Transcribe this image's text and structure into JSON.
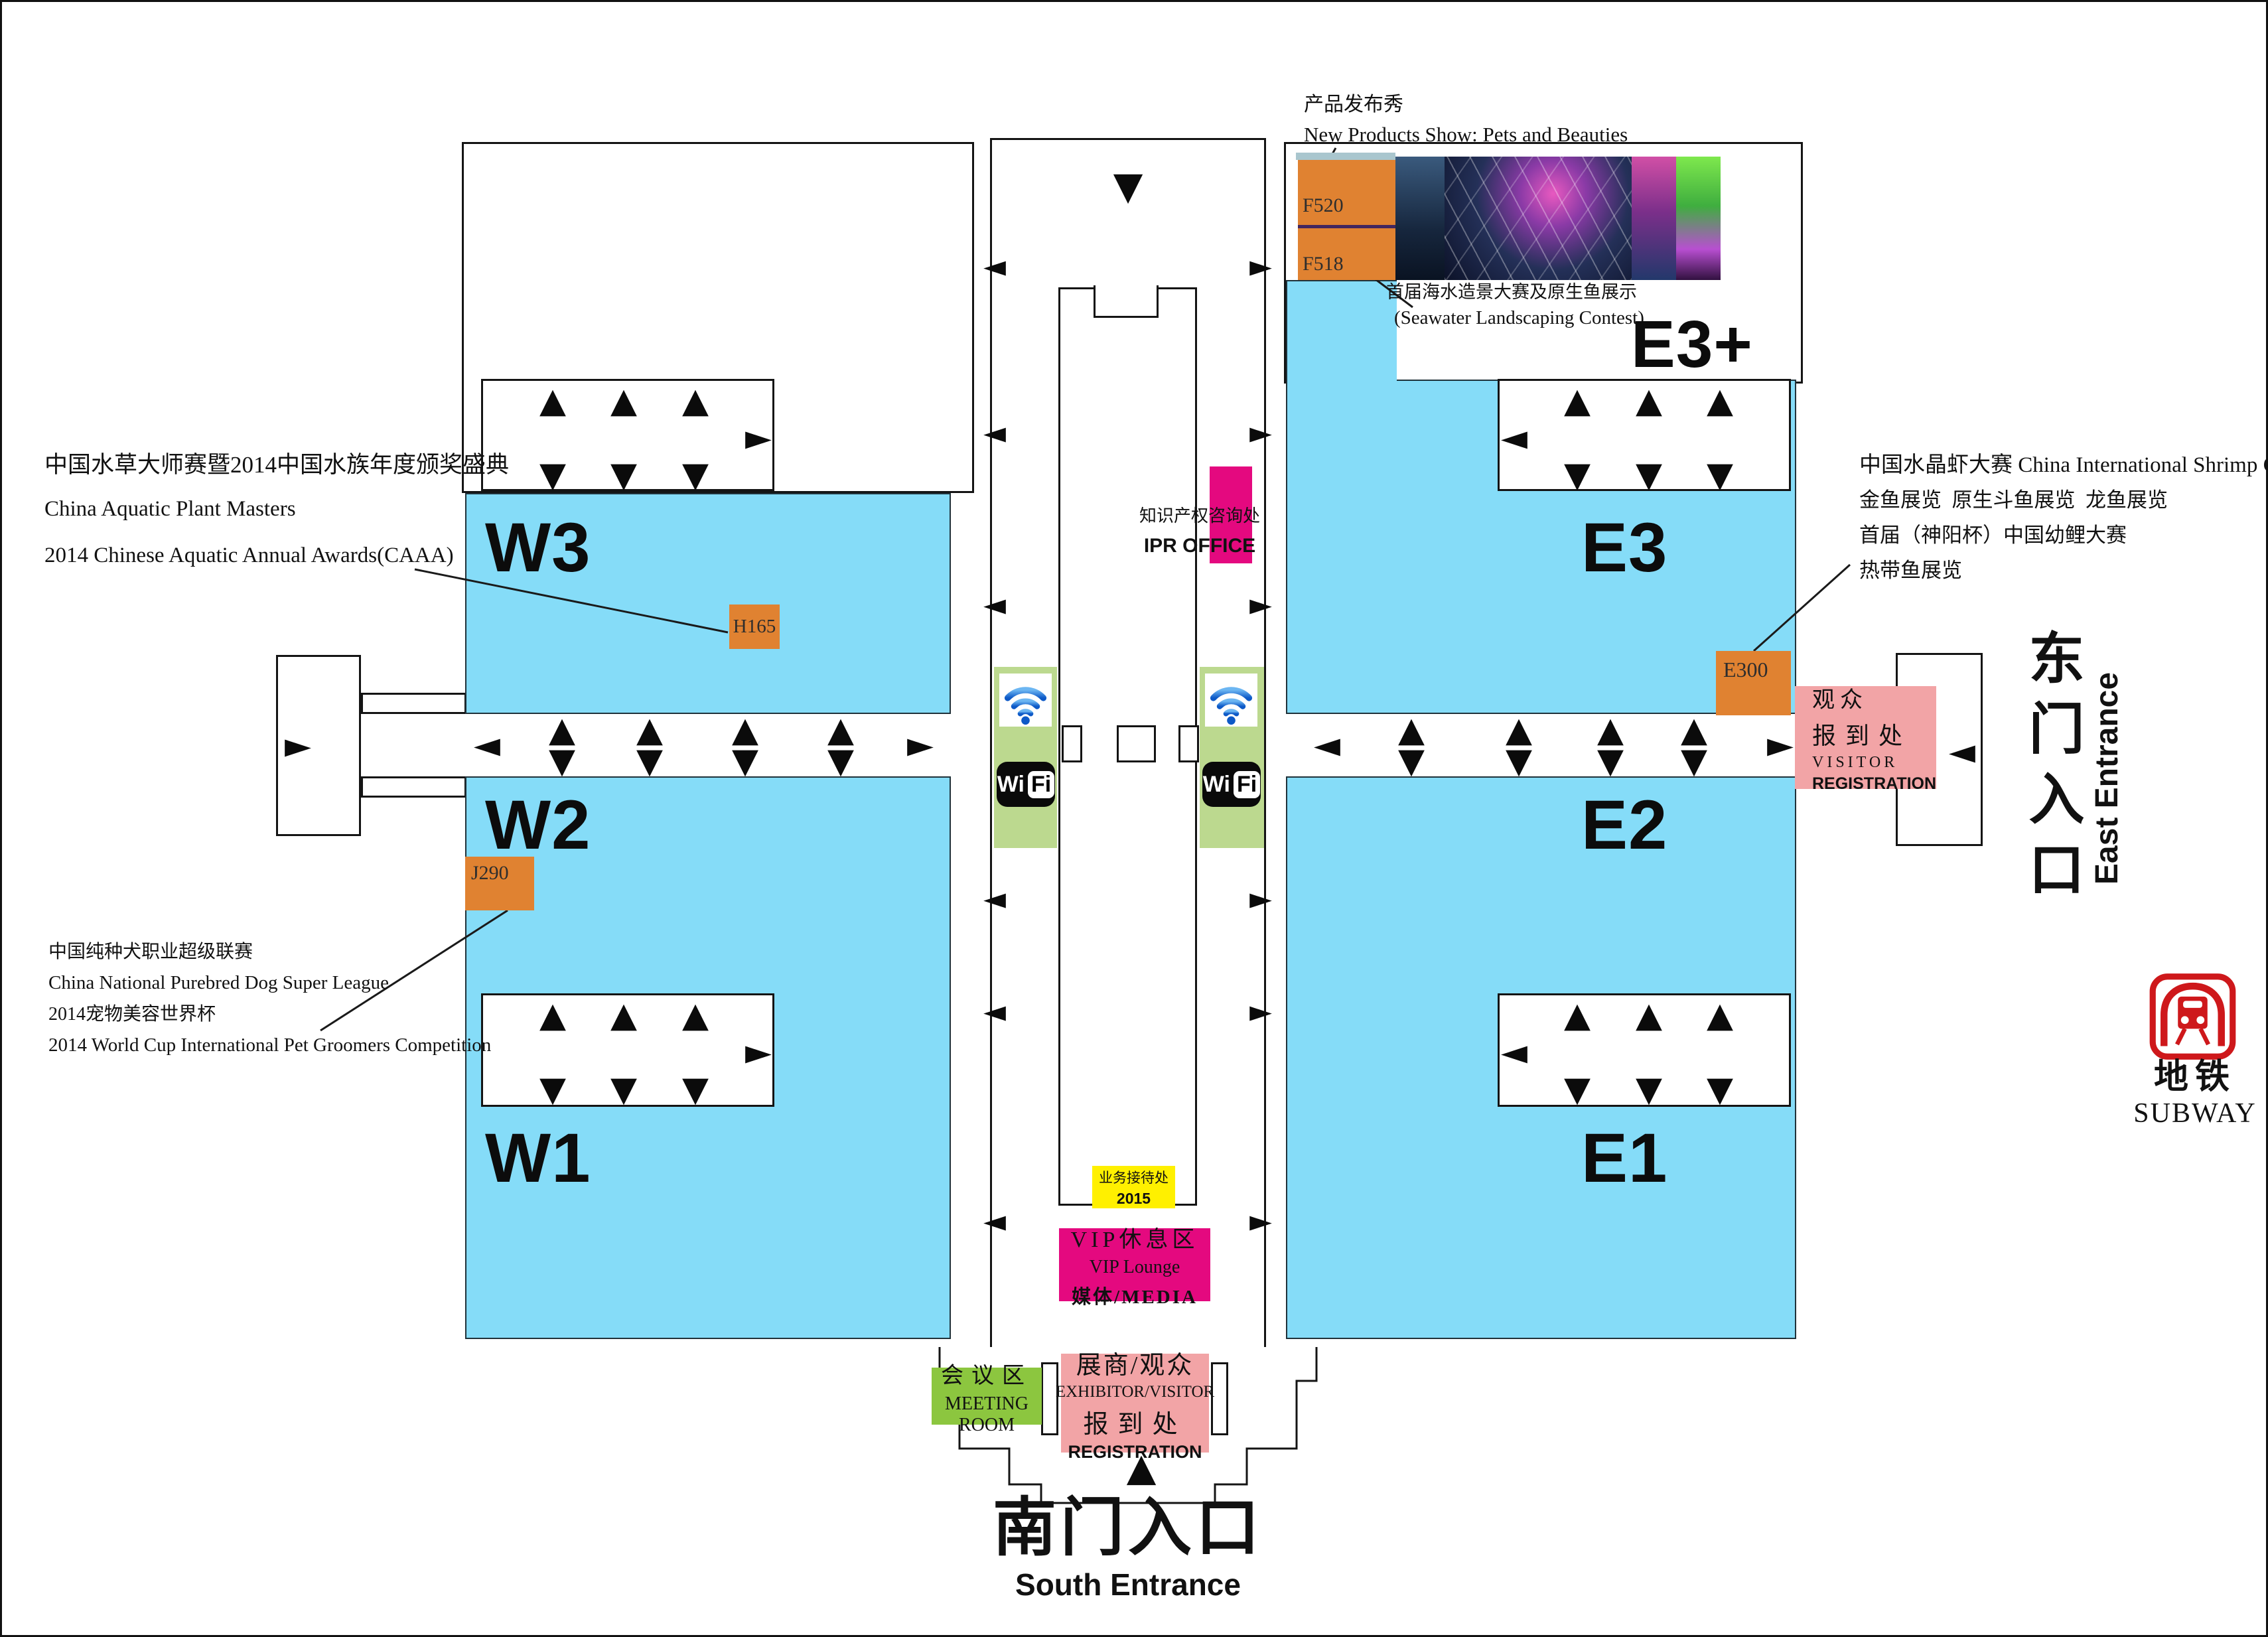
{
  "halls": {
    "w3": "W3",
    "w2": "W2",
    "w1": "W1",
    "e3": "E3",
    "e2": "E2",
    "e1": "E1",
    "e3_plus": "E3+"
  },
  "booths": {
    "h165": "H165",
    "j290": "J290",
    "e300": "E300",
    "f520": "F520",
    "f518": "F518"
  },
  "product_show": {
    "zh": "产品发布秀",
    "en": "New Products Show: Pets and Beauties"
  },
  "seawater": {
    "zh": "首届海水造景大赛及原生鱼展示",
    "en": "(Seawater Landscaping Contest)"
  },
  "notes_left_top": {
    "zh": "中国水草大师赛暨2014中国水族年度颁奖盛典",
    "en1": "China Aquatic Plant Masters",
    "en2": "2014 Chinese Aquatic Annual Awards(CAAA)"
  },
  "notes_left_bottom": {
    "zh1": "中国纯种犬职业超级联赛",
    "en1": "China National Purebred Dog Super League",
    "zh2": "2014宠物美容世界杯",
    "en2": "2014 World Cup International Pet Groomers Competition"
  },
  "notes_right": {
    "line1": "中国水晶虾大赛 China International Shrimp Contest",
    "line2": "金鱼展览  原生斗鱼展览  龙鱼展览",
    "line3": "首届（神阳杯）中国幼鲤大赛",
    "line4": "热带鱼展览"
  },
  "ipr": {
    "zh": "知识产权咨询处",
    "en": "IPR OFFICE"
  },
  "service_desk": {
    "zh": "业务接待处",
    "year": "2015"
  },
  "vip": {
    "zh": "VIP休息区",
    "en": "VIP Lounge",
    "media": "媒体/MEDIA"
  },
  "meeting": {
    "zh": "会议区",
    "en": "MEETING ROOM"
  },
  "exhibitor_registration": {
    "zh1": "展商/观众",
    "en1": "EXHIBITOR/VISITOR",
    "zh2": "报到处",
    "en2": "REGISTRATION"
  },
  "visitor_registration": {
    "zh1": "观众",
    "zh2": "报到处",
    "en1": "VISITOR",
    "en2": "REGISTRATION"
  },
  "entrance_south": {
    "zh": "南门入口",
    "en": "South Entrance"
  },
  "entrance_east": {
    "zh": "东门入口",
    "en": "East Entrance"
  },
  "subway": {
    "zh": "地铁",
    "en": "SUBWAY"
  },
  "wifi": {
    "wi": "Wi",
    "fi": "Fi"
  },
  "icons": {
    "arrow_up": "▲",
    "arrow_down": "▼",
    "arrow_left": "◄",
    "arrow_right": "►"
  },
  "colors": {
    "hall_blue": "#85DCF8",
    "booth_orange": "#E08231",
    "wifi_green": "#BCD98F",
    "magenta": "#E4097F",
    "pink": "#F2A4A6",
    "meeting_green": "#8CC63F",
    "service_yellow": "#FFF000",
    "subway_red": "#CE181B",
    "divider_purple": "#42265F"
  }
}
